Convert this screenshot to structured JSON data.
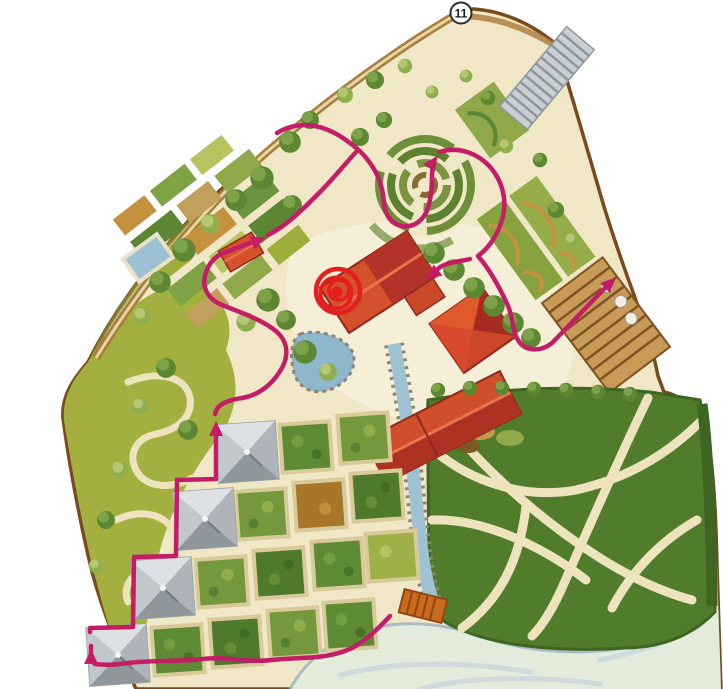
{
  "map": {
    "type": "illustrated-garden-plan",
    "section_marker": {
      "label": "11"
    },
    "route": {
      "color": "#c31d68",
      "arrow_count": 6
    },
    "highlight_marker": {
      "color": "#e3201f"
    },
    "palette": {
      "parchment": "#efe7c5",
      "plaza": "#f6efd8",
      "meadow": "#a3af3f",
      "woodland": "#4f7a2c",
      "roof_red": "#d4512b",
      "roof_dark": "#b23327",
      "pyramid_grey": "#b3b8bc",
      "water": "#9fc2d2",
      "pale_lake": "#e3ecdb",
      "border_brown": "#7a4a1f",
      "path_cream": "#ede3bc",
      "bridge_orange": "#c96a1e"
    }
  }
}
